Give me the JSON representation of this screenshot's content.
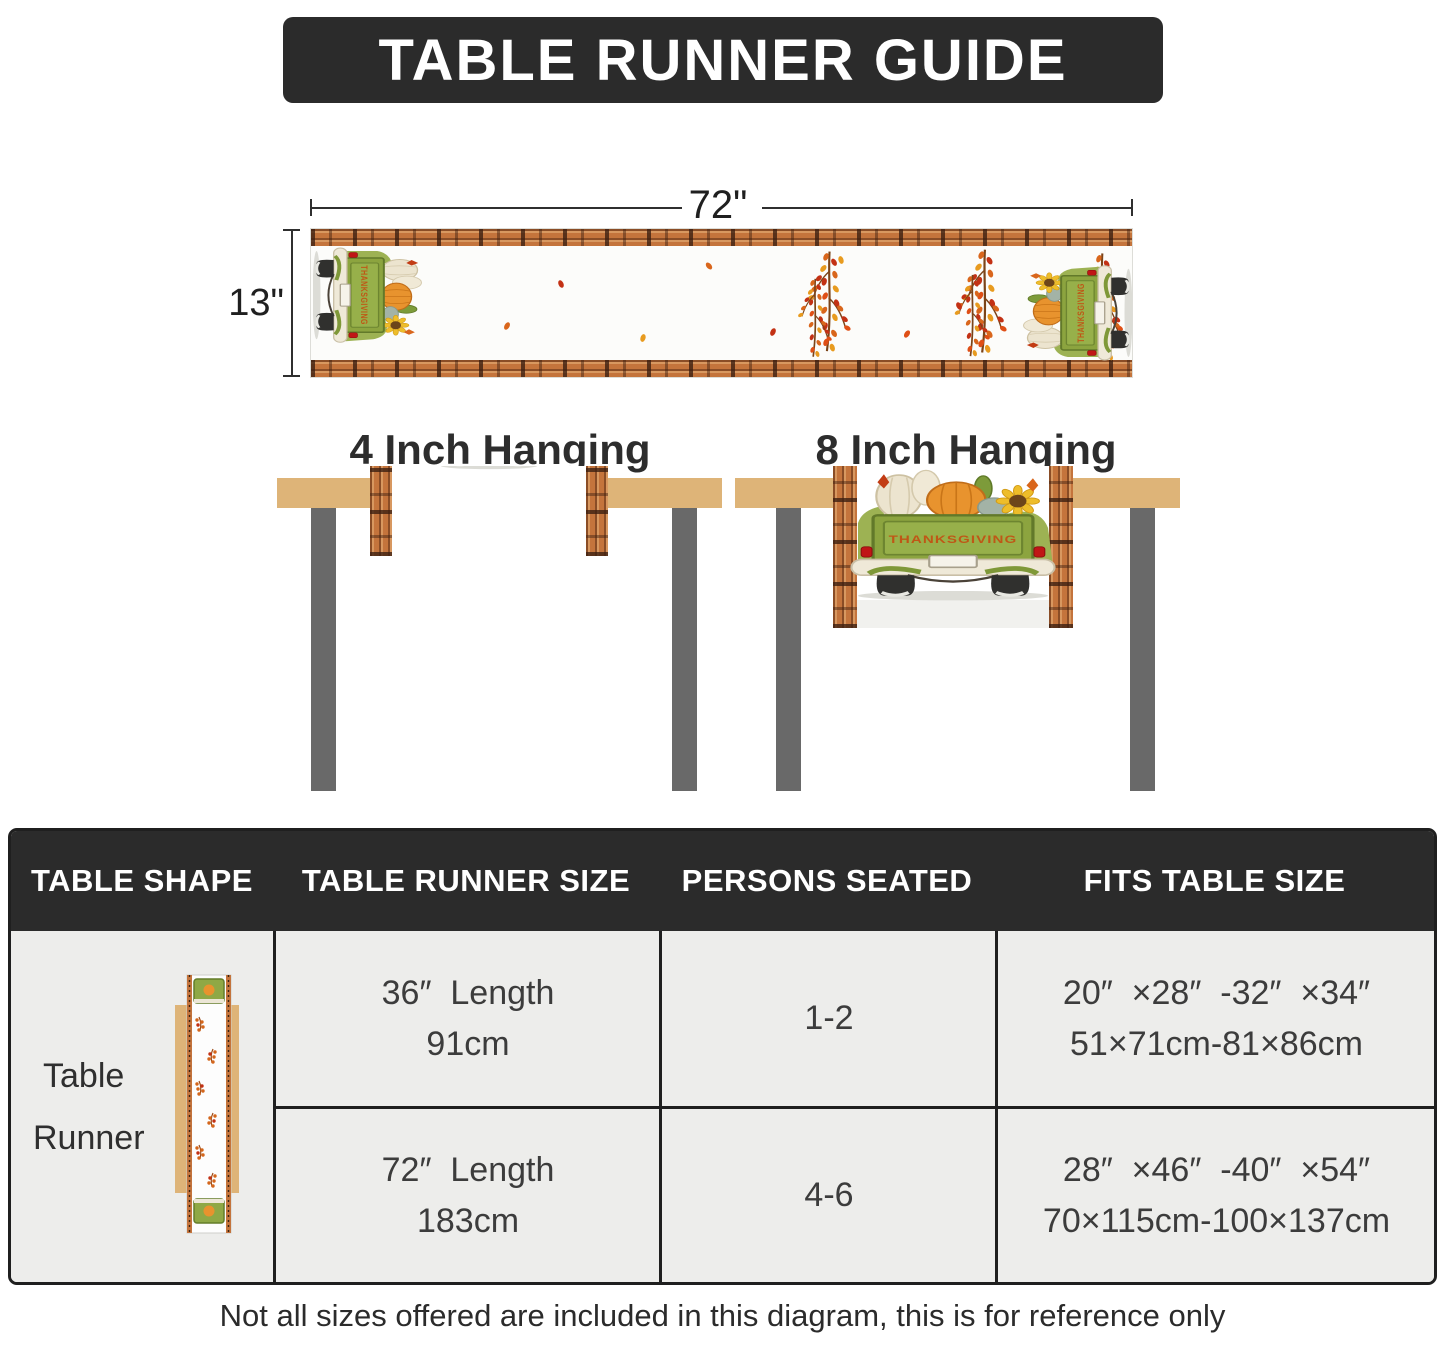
{
  "title": "TABLE RUNNER GUIDE",
  "runner_diagram": {
    "width_label": "72\"",
    "height_label": "13\""
  },
  "truck_text": "THANKSGIVING",
  "hanging": {
    "left_label": "4 Inch Hanging",
    "right_label": "8 Inch Hanging"
  },
  "spec_table": {
    "headers": [
      "TABLE SHAPE",
      "TABLE RUNNER SIZE",
      "PERSONS SEATED",
      "FITS TABLE SIZE"
    ],
    "shape_line1": "Table",
    "shape_line2": "Runner",
    "rows": [
      {
        "size_line1": "36″  Length",
        "size_line2": "91cm",
        "persons": "1-2",
        "fits_line1": "20″  ×28″  -32″  ×34″",
        "fits_line2": "51×71cm-81×86cm"
      },
      {
        "size_line1": "72″  Length",
        "size_line2": "183cm",
        "persons": "4-6",
        "fits_line1": "28″  ×46″  -40″  ×54″",
        "fits_line2": "70×115cm-100×137cm"
      }
    ]
  },
  "disclaimer": "Not all sizes offered are included in this diagram, this is for reference only",
  "colors": {
    "banner_dark": "#2b2b2b",
    "tabletop_tan": "#deb478",
    "leg_gray": "#696969",
    "plaid_orange": "#c4743c",
    "truck_green": "#94ad45",
    "pumpkin_orange": "#e8932e",
    "leaf_red": "#c33114",
    "body_gray": "#ededeb"
  }
}
